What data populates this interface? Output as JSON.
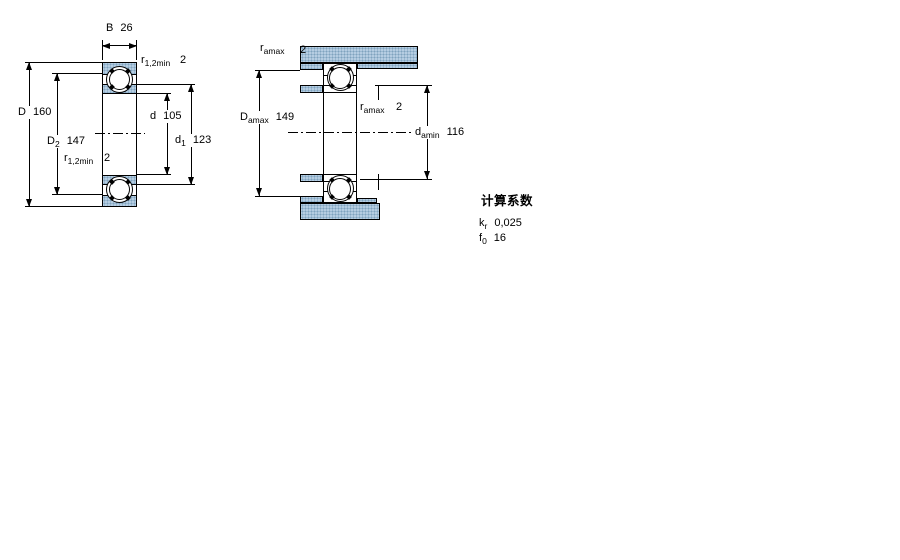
{
  "drawing": {
    "left_view": {
      "width": {
        "symbol": "B",
        "value": "26"
      },
      "radius_top": {
        "symbol": "r",
        "subscript": "1,2min",
        "value": "2"
      },
      "outer_diameter": {
        "symbol": "D",
        "value": "160"
      },
      "recess_diameter": {
        "symbol": "D",
        "subscript": "2",
        "value": "147"
      },
      "radius_bottom": {
        "symbol": "r",
        "subscript": "1,2min",
        "value": "2"
      },
      "bore_diameter": {
        "symbol": "d",
        "value": "105"
      },
      "shoulder_diameter": {
        "symbol": "d",
        "subscript": "1",
        "value": "123"
      }
    },
    "right_view": {
      "fillet_top": {
        "symbol": "r",
        "subscript": "amax",
        "value": "2"
      },
      "housing_shoulder_max": {
        "symbol": "D",
        "subscript": "amax",
        "value": "149"
      },
      "fillet_mid": {
        "symbol": "r",
        "subscript": "amax",
        "value": "2"
      },
      "shaft_shoulder_min": {
        "symbol": "d",
        "subscript": "amin",
        "value": "116"
      }
    },
    "calculation_factors": {
      "heading": "计算系数",
      "factors": [
        {
          "symbol": "k",
          "subscript": "r",
          "value": "0,025"
        },
        {
          "symbol": "f",
          "subscript": "0",
          "value": "16"
        }
      ]
    },
    "colors": {
      "section_fill": "#b5cde2",
      "section_dot": "#7fa3bf",
      "line": "#000000",
      "background": "#ffffff"
    }
  }
}
